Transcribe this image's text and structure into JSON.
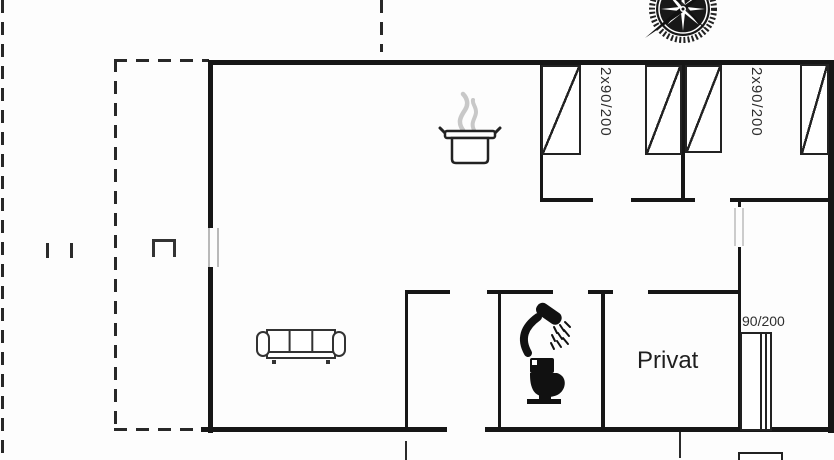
{
  "plan": {
    "type": "holiday-house floor plan",
    "rooms": {
      "bedroom_a": {
        "bed_label": "2x90/200"
      },
      "bedroom_b": {
        "bed_label": "2x90/200"
      },
      "single_bed_room": {
        "bed_label": "90/200"
      },
      "private_room": {
        "name": "Privat"
      }
    },
    "icons": {
      "orientation": "compass-rose-icon",
      "kitchen": "cooking-pot-icon",
      "living_room": "sofa-icon",
      "bathroom": [
        "shower-icon",
        "toilet-icon"
      ],
      "beds": "bed-symbol-with-diagonal"
    },
    "colors": {
      "background": "#fdfdfd",
      "wall": "#161616",
      "thin_line": "#2b2b2b",
      "window_line": "#b9b9b9",
      "door_line": "#cccccc",
      "steam_gray": "#c8c8c8"
    }
  }
}
